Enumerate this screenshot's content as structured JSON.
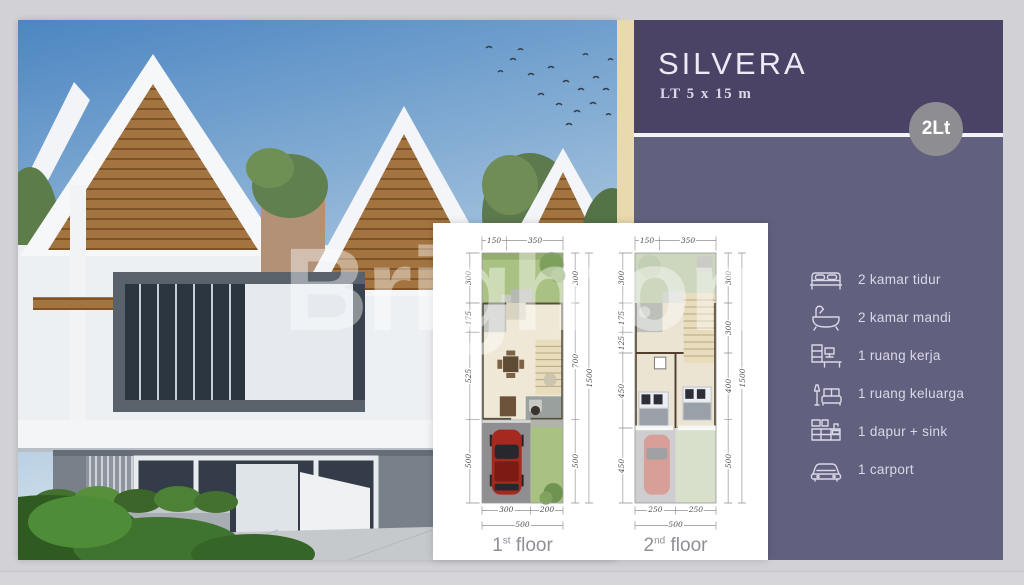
{
  "panel": {
    "title": "SILVERA",
    "subtitle": "LT 5 x 15 m",
    "badge_label": "2Lt",
    "features": [
      {
        "icon": "bed-icon",
        "label": "2 kamar tidur"
      },
      {
        "icon": "bathtub-icon",
        "label": "2 kamar mandi"
      },
      {
        "icon": "desk-icon",
        "label": "1 ruang kerja"
      },
      {
        "icon": "sofa-icon",
        "label": "1 ruang keluarga"
      },
      {
        "icon": "kitchen-icon",
        "label": "1 dapur + sink"
      },
      {
        "icon": "car-icon",
        "label": "1 carport"
      }
    ]
  },
  "watermark": "Brighton",
  "floor_plans": {
    "plan1": {
      "caption_number": "1",
      "caption_suffix": "st",
      "caption_rest": " floor",
      "top": [
        "150",
        "350"
      ],
      "left": [
        "300",
        "175",
        "525",
        "500"
      ],
      "right": [
        "300",
        "700",
        "500"
      ],
      "total_height": "1500",
      "bottom": [
        "300",
        "200"
      ],
      "total_width": "500"
    },
    "plan2": {
      "caption_number": "2",
      "caption_suffix": "nd",
      "caption_rest": " floor",
      "top": [
        "150",
        "350"
      ],
      "left": [
        "300",
        "175",
        "125",
        "450",
        "450"
      ],
      "right": [
        "300",
        "300",
        "400",
        "500"
      ],
      "total_height": "1500",
      "bottom": [
        "250",
        "250"
      ],
      "total_width": "500"
    }
  },
  "colors": {
    "header_purple": "#4a4366",
    "body_purple": "#61617f",
    "accent_beige": "#e9d9ae",
    "badge_gray": "#8d8d92",
    "text_light": "#d9d8e6"
  }
}
